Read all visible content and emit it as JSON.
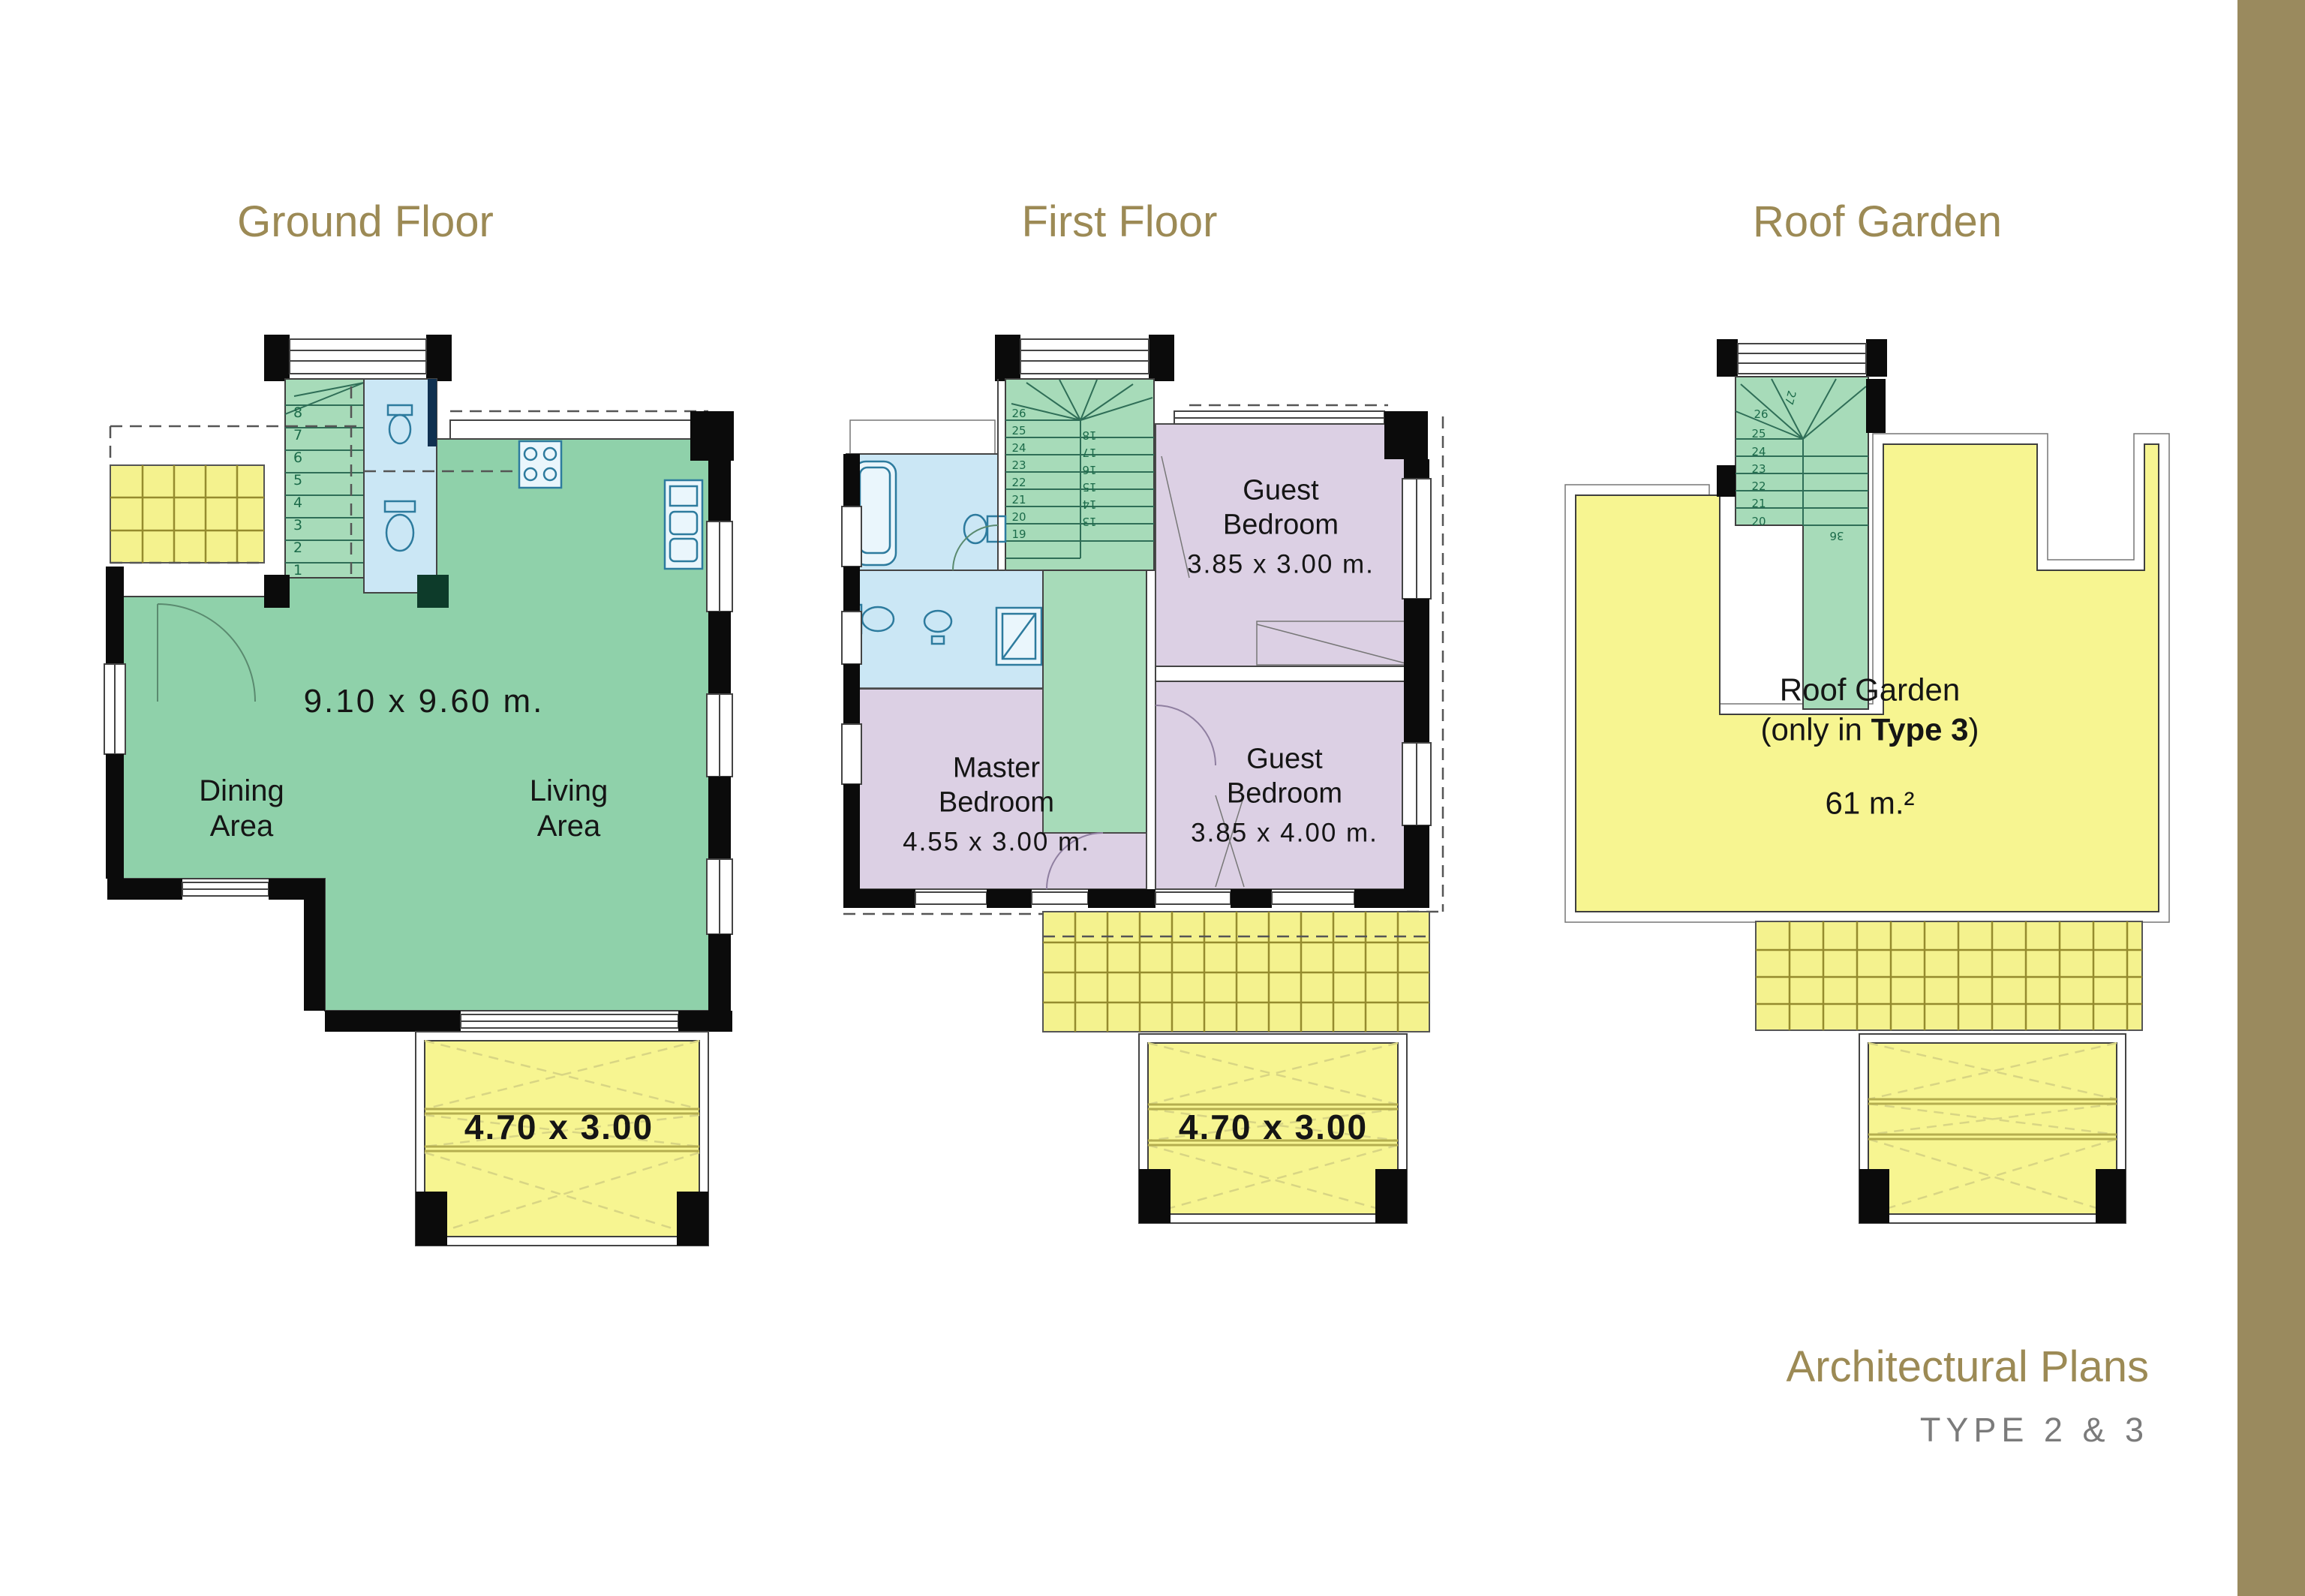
{
  "page": {
    "background": "#ffffff",
    "side_stripe_color": "#9a8a5e"
  },
  "titles": {
    "ground_floor": "Ground Floor",
    "first_floor": "First Floor",
    "roof_garden": "Roof Garden"
  },
  "footer": {
    "title": "Architectural Plans",
    "subtitle": "TYPE 2 & 3"
  },
  "palette": {
    "title_tan": "#9c8a55",
    "subtitle_gray": "#7b7b7b",
    "living_green": "#8fd1aa",
    "stair_green": "#a7dbb9",
    "bath_blue": "#cbe7f5",
    "bedroom_purple": "#dcd0e4",
    "terrace_yellow": "#f7f591",
    "pergola_yellow": "#f4f28e",
    "wall_black": "#0b0b0b"
  },
  "ground_floor": {
    "overall_dimension": "9.10 x 9.60 m.",
    "dining_label": "Dining Area",
    "living_label": "Living Area",
    "balcony_dimension": "4.70 x 3.00",
    "stair_numbers": [
      "1",
      "2",
      "3",
      "4",
      "5",
      "6",
      "7",
      "8"
    ]
  },
  "first_floor": {
    "guest_bedroom_top": {
      "name": "Guest Bedroom",
      "dimension": "3.85 x 3.00 m."
    },
    "master_bedroom": {
      "name": "Master Bedroom",
      "dimension": "4.55 x 3.00 m."
    },
    "guest_bedroom_bottom": {
      "name": "Guest Bedroom",
      "dimension": "3.85 x 4.00 m."
    },
    "balcony_dimension": "4.70 x 3.00",
    "stair_numbers_left": [
      "19",
      "20",
      "21",
      "22",
      "23",
      "24",
      "25",
      "26"
    ],
    "stair_numbers_right": [
      "13",
      "14",
      "15",
      "16",
      "17",
      "18"
    ]
  },
  "roof_garden": {
    "label": "Roof Garden",
    "note_prefix": "(only in ",
    "note_bold": "Type 3",
    "note_suffix": ")",
    "area": "61 m.²",
    "stair_numbers": [
      "20",
      "21",
      "22",
      "23",
      "24",
      "25",
      "26"
    ],
    "fan_number": "27",
    "landing_number": "36"
  }
}
